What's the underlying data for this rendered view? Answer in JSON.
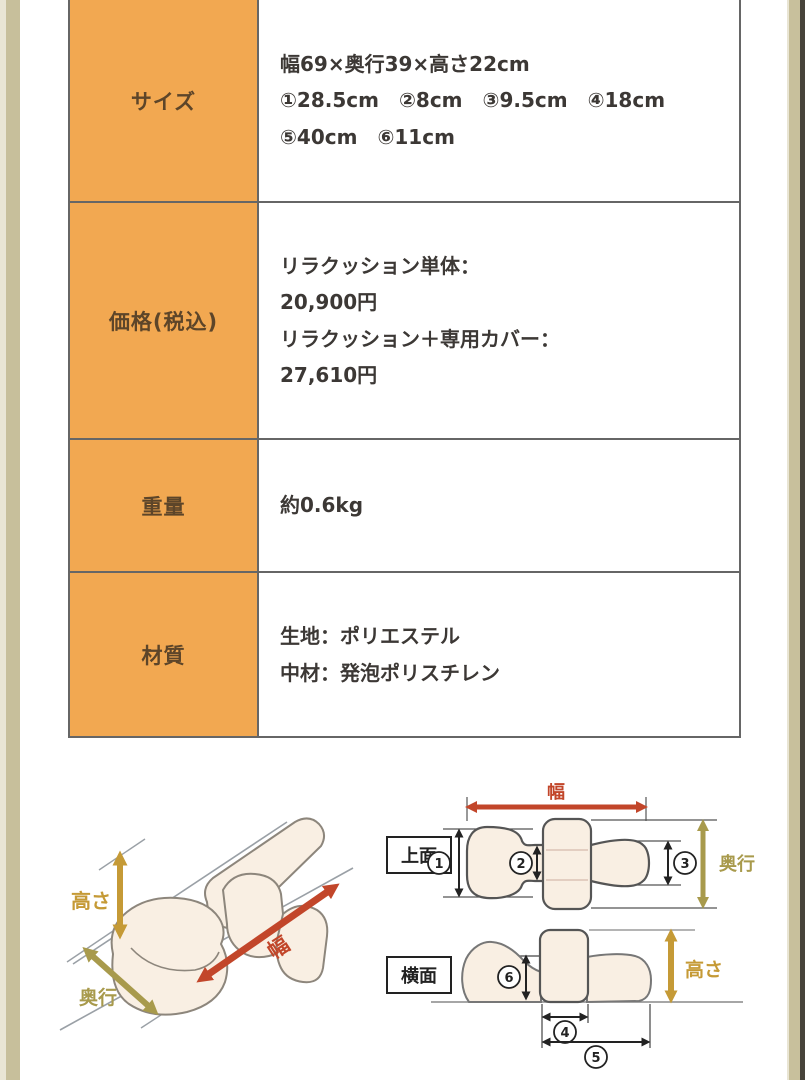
{
  "page": {
    "background": "#ffffff"
  },
  "frame": {
    "left_outer_color": "#e9e5d4",
    "left_inner_color": "#c7bf9b",
    "right_inner_color": "#c8c09c",
    "right_edge_color": "#47433a"
  },
  "table": {
    "border_color": "#666666",
    "label_bg": "#f2a851",
    "label_text_color": "#5d4529",
    "content_text_color": "#3c3835",
    "rows": [
      {
        "label": "サイズ",
        "lines": [
          "幅69×奥行39×高さ22cm",
          "①28.5cm　②8cm　③9.5cm　④18cm",
          "⑤40cm　⑥11cm"
        ]
      },
      {
        "label": "価格(税込)",
        "lines": [
          "リラクッション単体：",
          "20,900円",
          "リラクッション＋専用カバー：",
          "27,610円"
        ]
      },
      {
        "label": "重量",
        "lines": [
          "約0.6kg"
        ]
      },
      {
        "label": "材質",
        "lines": [
          "生地：ポリエステル",
          "中材：発泡ポリスチレン"
        ]
      }
    ]
  },
  "diagrams": {
    "labels": {
      "width": "幅",
      "depth": "奥行",
      "height": "高さ",
      "top_view": "上面",
      "side_view": "横面"
    },
    "callouts": [
      "1",
      "2",
      "3",
      "4",
      "5",
      "6"
    ],
    "colors": {
      "width_arrow": "#c2462a",
      "depth_arrow": "#a89a4c",
      "height_arrow": "#c59a36",
      "cushion_fill": "#f9efe3",
      "outline": "#6e6e6e"
    }
  }
}
